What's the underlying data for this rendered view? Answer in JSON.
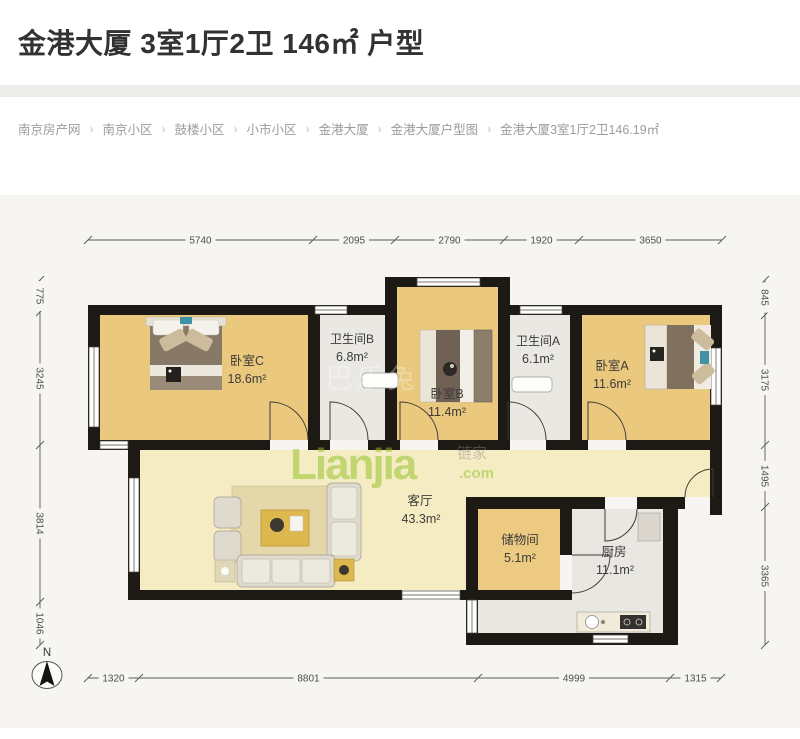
{
  "page": {
    "title": "金港大厦 3室1厅2卫 146㎡ 户型"
  },
  "breadcrumb": {
    "separator": "›",
    "items": [
      "南京房产网",
      "南京小区",
      "鼓楼小区",
      "小市小区",
      "金港大厦",
      "金港大厦户型图"
    ],
    "current": "金港大厦3室1厅2卫146.19㎡"
  },
  "floorplan": {
    "rooms": [
      {
        "name": "卧室C",
        "area": "18.6m²"
      },
      {
        "name": "卫生间B",
        "area": "6.8m²"
      },
      {
        "name": "卧室B",
        "area": "11.4m²"
      },
      {
        "name": "卫生间A",
        "area": "6.1m²"
      },
      {
        "name": "卧室A",
        "area": "11.6m²"
      },
      {
        "name": "客厅",
        "area": "43.3m²"
      },
      {
        "name": "储物间",
        "area": "5.1m²"
      },
      {
        "name": "厨房",
        "area": "11.1m²"
      }
    ],
    "dimensions": {
      "top": [
        "5740",
        "2095",
        "2790",
        "1920",
        "3650"
      ],
      "left": [
        "775",
        "3245",
        "3814",
        "1046"
      ],
      "right": [
        "845",
        "3175",
        "1495",
        "3365"
      ],
      "bottom": [
        "1320",
        "8801",
        "4999",
        "1315"
      ]
    },
    "compass": {
      "label": "N"
    },
    "watermark": {
      "brand": "Lianjia",
      "suffix": ".com",
      "cjk": "链家",
      "faint": "巴乐兔"
    },
    "colors": {
      "wall": "#1d1915",
      "bedroom_floor": "#eac87d",
      "living_floor": "#f5ecc4",
      "wet_floor": "#eae8e3",
      "watermark_green": "#8fbf21"
    }
  }
}
